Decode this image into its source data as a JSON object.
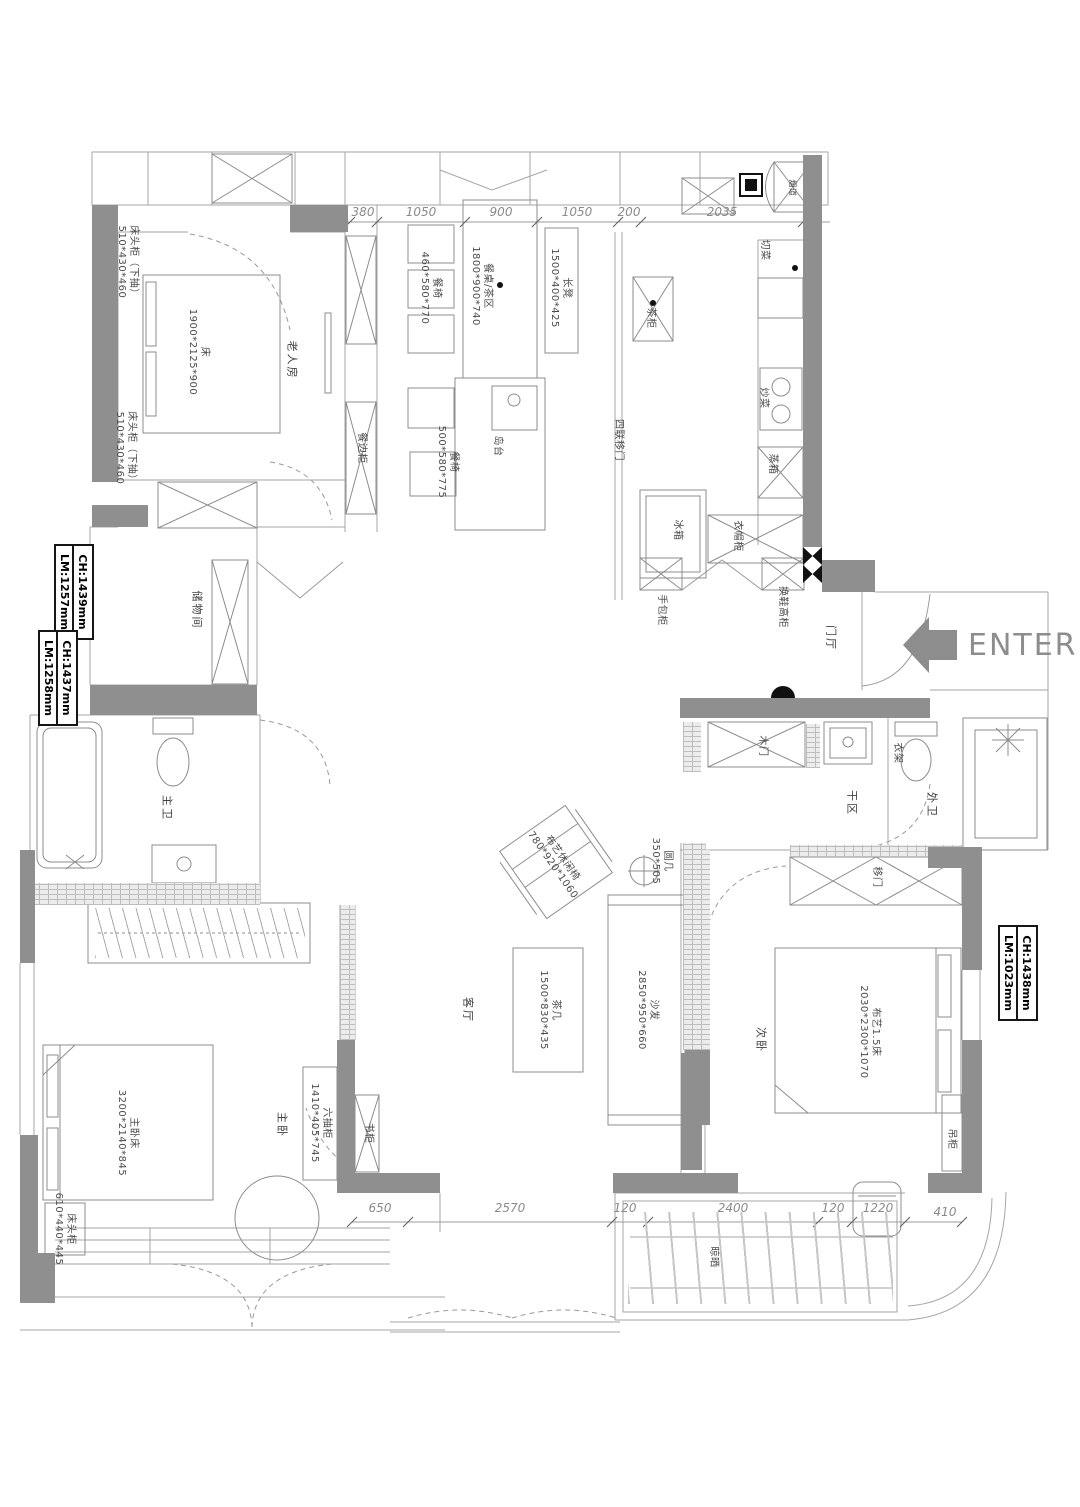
{
  "enter": {
    "label": "ENTER"
  },
  "dims": {
    "top": [
      "380",
      "1050",
      "900",
      "1050",
      "200",
      "2035"
    ],
    "bottom": [
      "650",
      "2570",
      "120",
      "2400",
      "120",
      "1220",
      "410"
    ]
  },
  "tags": {
    "left_upper_lm": "LM:1257mm",
    "left_upper_ch": "CH:1439mm",
    "left_lower_lm": "LM:1258mm",
    "left_lower_ch": "CH:1437mm",
    "right_lm": "LM:1023mm",
    "right_ch": "CH:1438mm"
  },
  "labels": {
    "elder_room": "老人房",
    "elder_bed": "床\n1900*2125*900",
    "nightstand_a": "床头柜（下抽）\n510*430*460",
    "nightstand_b": "床头柜（下抽）\n510*430*460",
    "sideboard": "餐边柜",
    "chair_left": "餐椅\n460*580*770",
    "dining_table": "餐桌/茶区\n1800*900*740",
    "bench": "长凳\n1500*400*425",
    "island": "岛台",
    "chair_bottom": "餐椅\n500*580*775",
    "tea_cabinet": "茶柜",
    "four_panel_door": "四联移门",
    "chopping": "切菜",
    "cooking": "炒菜",
    "steamer": "蒸箱",
    "fridge": "冰箱",
    "coat_cabinet": "衣帽柜",
    "bag_cabinet": "手包柜",
    "shoe_cabinet": "换鞋高柜",
    "flue": "烟道",
    "foyer": "门厅",
    "storage": "储物间",
    "master_bath": "主卫",
    "dry_area": "干区",
    "wood_door": "木门",
    "clothes_rack": "衣架",
    "guest_bath": "外卫",
    "living_room": "客厅",
    "tea_table": "茶几\n1500*830*435",
    "sofa": "沙发\n2850*950*660",
    "round_table": "圆几\n350*505",
    "lounge_chair": "布艺休闲椅\n780*920*1060",
    "master_room": "主卧",
    "master_bed": "主卧床\n3200*2140*845",
    "master_nightstand": "床头柜\n610*440*445",
    "six_drawer": "六抽柜\n1410*405*745",
    "bookcase": "书柜",
    "second_room": "次卧",
    "second_bed": "布艺1.5床\n2030*2300*1070",
    "sliding_door": "移门",
    "hanging_cabinet": "吊柜",
    "drying": "晾晒"
  },
  "colors": {
    "wall": "#8f8f8f",
    "line": "#a6a6a6",
    "text": "#4a4a4a",
    "accent_black": "#111111"
  }
}
